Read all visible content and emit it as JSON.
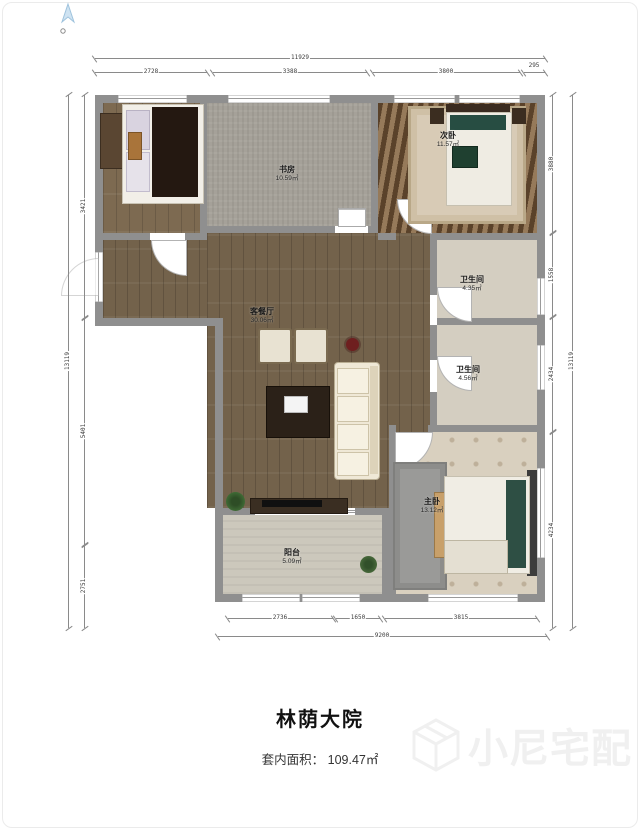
{
  "meta": {
    "project_name": "林荫大院",
    "area_label": "套内面积：",
    "area_value": "109.47㎡"
  },
  "watermark": {
    "text": "小尼宅配",
    "icon": "cube-logo-icon",
    "color": "#f0f0f0"
  },
  "compass": {
    "icon": "north-arrow-icon",
    "color": "#a9c8e0"
  },
  "rooms": {
    "study": {
      "name": "书房",
      "area": "10.59㎡"
    },
    "bedroom2": {
      "name": "次卧",
      "area": "11.57㎡"
    },
    "bath1": {
      "name": "卫生间",
      "area": "4.35㎡"
    },
    "bath2": {
      "name": "卫生间",
      "area": "4.56㎡"
    },
    "living": {
      "name": "客餐厅",
      "area": "30.06㎡"
    },
    "master": {
      "name": "主卧",
      "area": "13.12㎡"
    },
    "balcony": {
      "name": "阳台",
      "area": "5.09㎡"
    }
  },
  "dims": {
    "top": {
      "overall": "11929",
      "segments": [
        "2728",
        "3388",
        "3800",
        "295"
      ]
    },
    "bottom": {
      "overall": "9200",
      "segments": [
        "2736",
        "1650",
        "3815"
      ]
    },
    "left": {
      "overall": "13119",
      "segments": [
        "3421",
        "5401",
        "2751"
      ]
    },
    "right": {
      "overall": "13119",
      "segments": [
        "3880",
        "1558",
        "2434",
        "4234"
      ]
    }
  },
  "colors": {
    "wall": "#8f8f8f",
    "wood_floor": "#7d6a51",
    "gray_carpet": "#a5a199",
    "master_floor": "#d9d0bf",
    "bath_floor": "#d4cec1"
  }
}
